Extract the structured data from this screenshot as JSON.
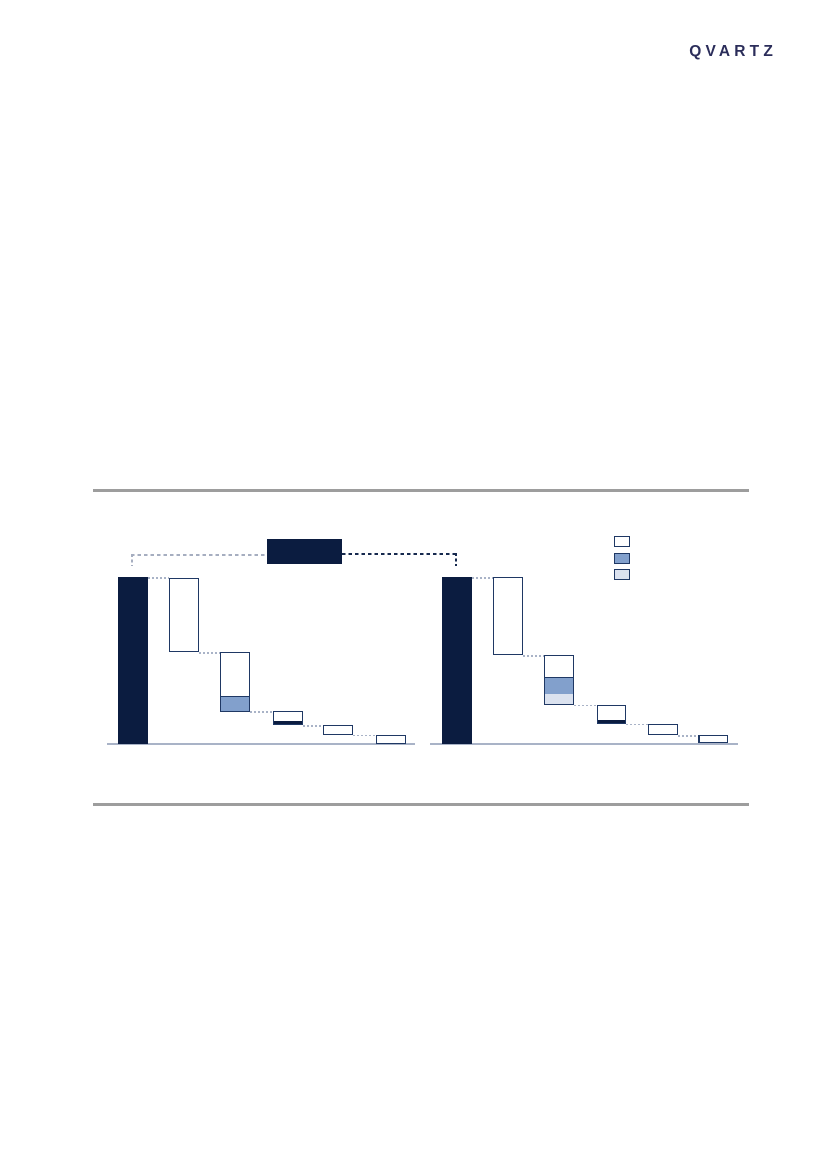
{
  "logo": {
    "text": "QVARTZ",
    "color": "#2b2d5a"
  },
  "colors": {
    "navy": "#0b1c40",
    "steel": "#82a0cc",
    "light_blue": "#dbe2ef",
    "white": "#ffffff",
    "bar_border": "#1f3864",
    "connector": "#a9b3c7",
    "baseline": "#a9b3c7",
    "rule": "#9d9d9d",
    "dash_left": "#a6aec0",
    "dash_right": "#16294e"
  },
  "callout": {
    "box": {
      "x": 267,
      "y": 539,
      "w": 75,
      "h": 25,
      "fill": "navy",
      "label": ""
    },
    "left_line": {
      "x1": 131,
      "x2": 267,
      "y": 554,
      "drop_y2": 566,
      "color": "dash_left"
    },
    "right_line": {
      "x1": 342,
      "x2": 457,
      "y": 552.5,
      "drop_y2": 566,
      "color": "dash_right"
    }
  },
  "legend": {
    "x": 614,
    "swatch_w": 16,
    "swatch_h": 11,
    "items": [
      {
        "name": "outline-series",
        "fill": "white",
        "y": 536,
        "label": ""
      },
      {
        "name": "steel-series",
        "fill": "steel",
        "y": 553,
        "label": ""
      },
      {
        "name": "light-series",
        "fill": "light_blue",
        "y": 569,
        "label": ""
      }
    ]
  },
  "chart_data": [
    {
      "type": "waterfall",
      "side": "left",
      "title": "",
      "xlabel": "",
      "ylabel": "",
      "axis_labels_visible": false,
      "total_pct": 100,
      "steps_pct": [
        44.3,
        35.9,
        8.4,
        5.7,
        5.7
      ],
      "baseline": {
        "x1": 107,
        "x2": 415,
        "y": 742.8
      },
      "bars": [
        {
          "x": 118.3,
          "w": 29.5,
          "top": 577,
          "h": 167,
          "fill": "navy",
          "border": false
        },
        {
          "x": 169,
          "w": 30,
          "top": 578,
          "h": 74,
          "fill": "white",
          "border": true
        },
        {
          "x": 220,
          "w": 30,
          "top": 652,
          "h": 60,
          "fill": "white",
          "border": true,
          "bottom_segments": [
            {
              "fill": "steel",
              "h": 15,
              "edge_top": true
            }
          ]
        },
        {
          "x": 273,
          "w": 29.5,
          "top": 711,
          "h": 14,
          "fill": "white",
          "border": true,
          "bottom_segments": [
            {
              "fill": "navy",
              "h": 3
            }
          ]
        },
        {
          "x": 323,
          "w": 30,
          "top": 725,
          "h": 9.5,
          "fill": "white",
          "border": true
        },
        {
          "x": 376,
          "w": 30,
          "top": 734.5,
          "h": 9,
          "fill": "white",
          "border": true
        }
      ],
      "connectors": [
        {
          "x1": 148,
          "x2": 169,
          "y": 577
        },
        {
          "x1": 199,
          "x2": 220,
          "y": 652
        },
        {
          "x1": 250,
          "x2": 273,
          "y": 711.3
        },
        {
          "x1": 302.5,
          "x2": 323,
          "y": 725
        },
        {
          "x1": 353,
          "x2": 376,
          "y": 734.5
        }
      ]
    },
    {
      "type": "waterfall",
      "side": "right",
      "title": "",
      "xlabel": "",
      "ylabel": "",
      "axis_labels_visible": false,
      "total_pct": 100,
      "steps_pct": [
        46.7,
        29.9,
        11.4,
        6.9,
        5.1
      ],
      "baseline": {
        "x1": 430,
        "x2": 738,
        "y": 742.8
      },
      "bars": [
        {
          "x": 441.7,
          "w": 30,
          "top": 577,
          "h": 167,
          "fill": "navy",
          "border": false
        },
        {
          "x": 492.7,
          "w": 30,
          "top": 577,
          "h": 78,
          "fill": "white",
          "border": true
        },
        {
          "x": 544.3,
          "w": 30,
          "top": 655,
          "h": 50,
          "fill": "white",
          "border": true,
          "bottom_segments": [
            {
              "fill": "steel",
              "h": 17.5,
              "edge_top": true
            },
            {
              "fill": "light_blue",
              "h": 10
            }
          ]
        },
        {
          "x": 596.7,
          "w": 29,
          "top": 704.5,
          "h": 19,
          "fill": "white",
          "border": true,
          "bottom_segments": [
            {
              "fill": "navy",
              "h": 3
            }
          ]
        },
        {
          "x": 647.7,
          "w": 30,
          "top": 723.5,
          "h": 11.5,
          "fill": "white",
          "border": true
        },
        {
          "x": 698.3,
          "w": 30,
          "top": 735,
          "h": 7.5,
          "fill": "white",
          "border": true,
          "edge_left": true
        }
      ],
      "connectors": [
        {
          "x1": 471.7,
          "x2": 492.7,
          "y": 577
        },
        {
          "x1": 522.7,
          "x2": 544.3,
          "y": 655
        },
        {
          "x1": 574.3,
          "x2": 596.7,
          "y": 704.5
        },
        {
          "x1": 625.7,
          "x2": 647.7,
          "y": 723.5
        },
        {
          "x1": 677.7,
          "x2": 698.3,
          "y": 735
        }
      ]
    }
  ]
}
